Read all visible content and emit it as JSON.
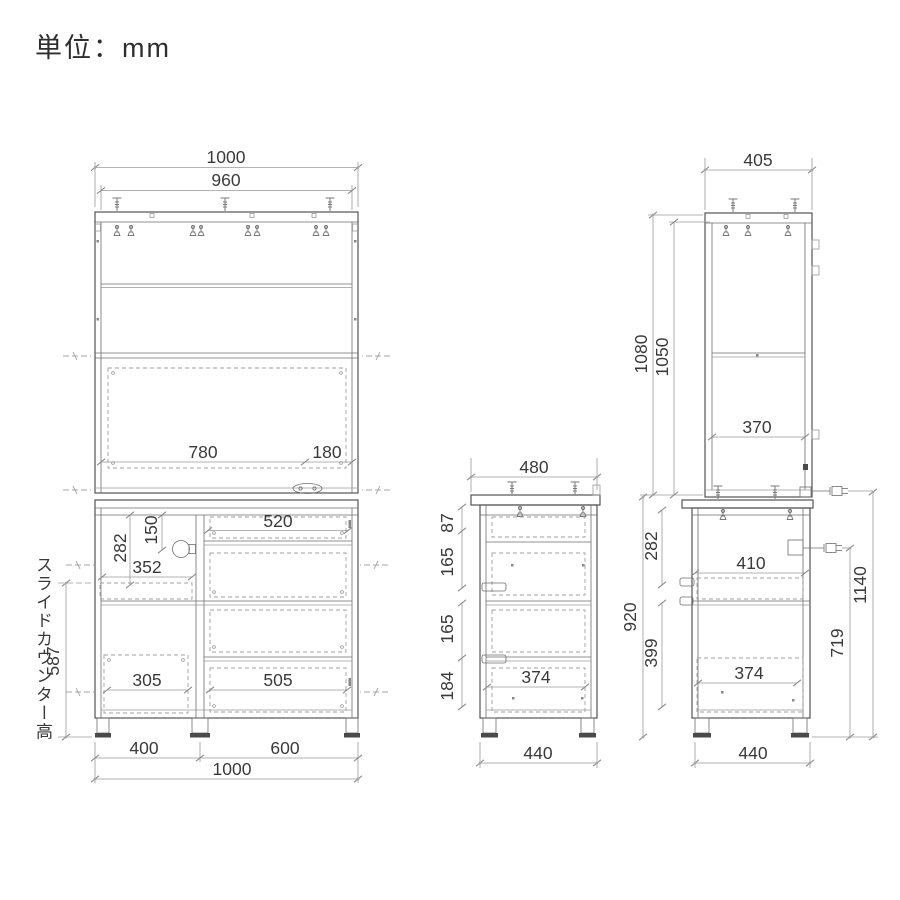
{
  "unit_label": "単位：mm",
  "front": {
    "total_width": "1000",
    "inner_width": "960",
    "flap_width": "780",
    "flap_right": "180",
    "left_height1": "282",
    "left_height2": "150",
    "slide_width": "352",
    "top_drawer_width": "520",
    "open_width": "305",
    "drawer_width": "505",
    "counter_label": "スライドカウンター高",
    "counter_height": "587",
    "base_left_width": "400",
    "base_right_width": "600",
    "base_total_width": "1000"
  },
  "side": {
    "top_depth": "480",
    "h1": "87",
    "h2": "165",
    "h3": "165",
    "h4": "184",
    "drawer_depth": "374",
    "base_depth": "440"
  },
  "tall_side": {
    "top_depth": "405",
    "upper_height": "1080",
    "upper_inner_height": "1050",
    "shelf_depth": "370",
    "h1": "282",
    "lower_height": "920",
    "h2": "399",
    "slide_depth": "410",
    "drawer_depth": "374",
    "outlet_height": "719",
    "total_height": "1140",
    "base_depth": "440"
  }
}
